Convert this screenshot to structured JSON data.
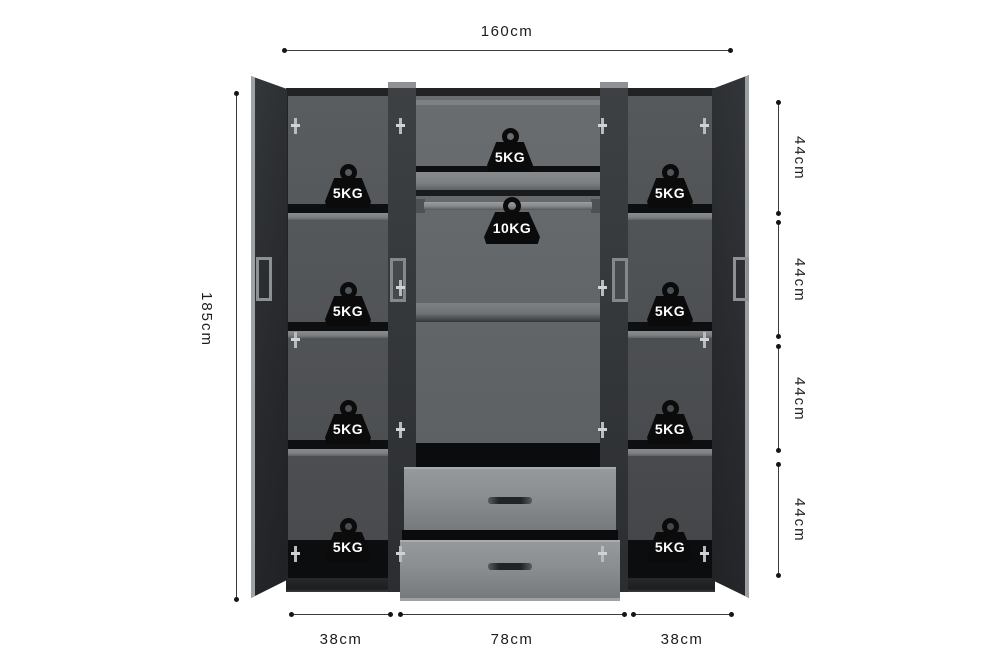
{
  "dimensions": {
    "width_top": "160cm",
    "height_left": "185cm",
    "right_segments": [
      "44cm",
      "44cm",
      "44cm",
      "44cm"
    ],
    "bottom_segments": [
      "38cm",
      "78cm",
      "38cm"
    ]
  },
  "weights": {
    "left_column": [
      "5KG",
      "5KG",
      "5KG",
      "5KG"
    ],
    "middle": {
      "top_shelf": "5KG",
      "hanging_rod": "10KG"
    },
    "right_column": [
      "5KG",
      "5KG",
      "5KG",
      "5KG"
    ]
  },
  "colors": {
    "bg": "#ffffff",
    "line": "#3c3c3c",
    "text": "#1d1d1d",
    "door-dark": "#2a2d30",
    "panel": "#36393c",
    "interior-side": "#515457",
    "interior-mid": "#63666a",
    "shelf-front": "#7d8083",
    "drawer-front": "#8b8e91",
    "metal": "#b9bcbf",
    "weight": "#0b0b0c",
    "weight-text": "#ffffff"
  }
}
